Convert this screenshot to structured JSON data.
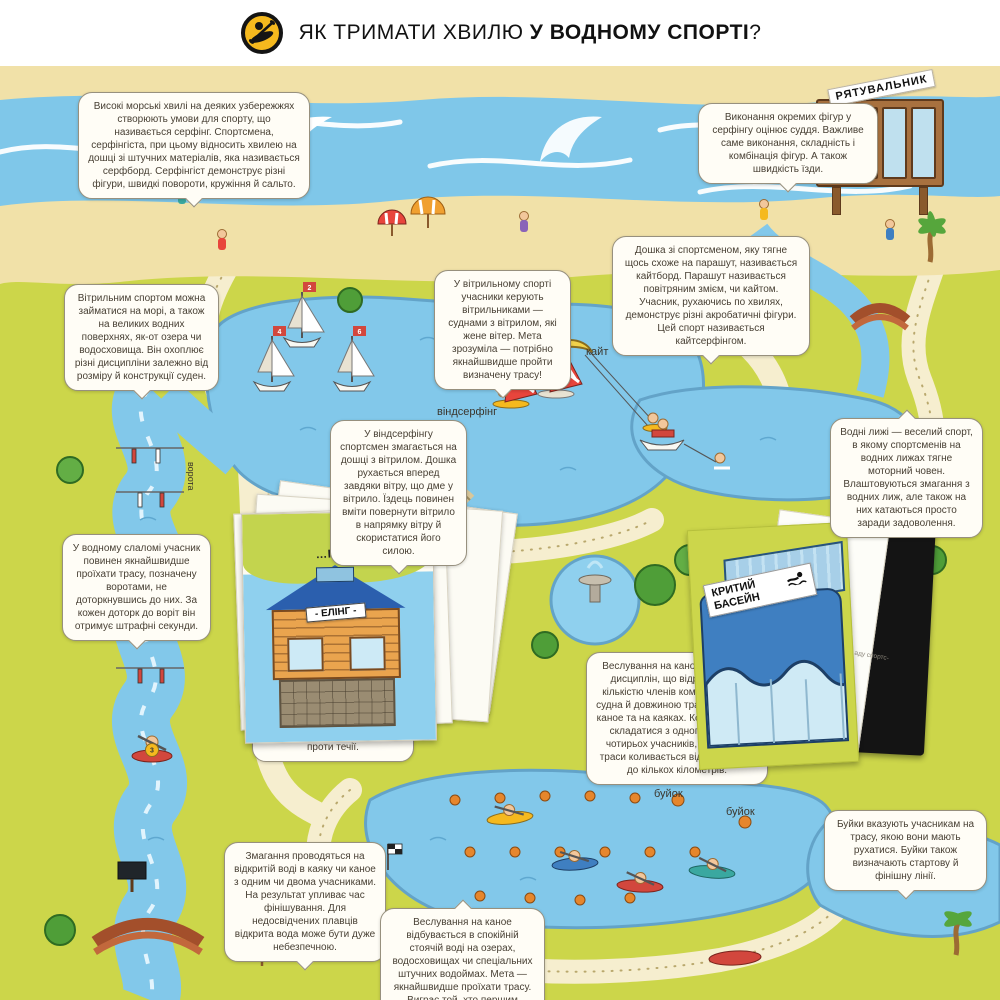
{
  "page": {
    "title": {
      "icon": "kayak-paddler-icon",
      "prefix": "ЯК ТРИМАТИ ХВИЛЮ ",
      "emphasis": "У ВОДНОМУ СПОРТІ",
      "suffix": "?"
    }
  },
  "callouts": {
    "surfing": "Високі морські хвилі на деяких узбережжях створюють умови для спорту, що називається серфінг. Спортсмена, серфінгіста, при цьому відносить хвилею на дошці зі штучних матеріалів, яка називається серфборд. Серфінгіст демонструє різні фігури, швидкі повороти, кружіння й сальто.",
    "surf_judging": "Виконання окремих фігур у серфінгу оцінює суддя. Важливе саме виконання, складність і комбінація фігур. А також швидкість їзди.",
    "kiteboard": "Дошка зі спортсменом, яку тягне щось схоже на парашут, називається кайтборд. Парашут називається повітряним змієм, чи кайтом. Учасник, рухаючись по хвилях, демонструє різні акробатичні фігури. Цей спорт називається кайтсерфінгом.",
    "sailing_overview": "Вітрильним спортом можна займатися на морі, а також на великих водних поверхнях, як-от озера чи водосховища. Він охоплює різні дисципліни залежно від розміру й конструкції суден.",
    "sailing_race": "У вітрильному спорті учасники керують вітрильниками — суднами з вітрилом, які жене вітер. Мета зрозуміла — потрібно якнайшвидше пройти визначену трасу!",
    "windsurfing": "У віндсерфінгу спортсмен змагається на дошці з вітрилом. Дошка рухається вперед завдяки вітру, що дме у вітрило. Їздець повинен вміти повернути вітрило в напрямку вітру й скористатися його силою.",
    "water_ski": "Водні лижі — веселий спорт, в якому спортсменів на водних лижах тягне моторний човен. Влаштовуються змагання з водних лиж, але також на них катаються просто заради задоволення.",
    "water_slalom": "У водному слаломі учасник повинен якнайшвидше проїхати трасу, позначену воротами, не доторкнувшись до них. За кожен доторк до воріт він отримує штрафні секунди.",
    "slalom_gates_partial": "в якому … проїхати спо… білі він має проїхати … води. Червоно-білі ма… подолати проти течії.",
    "canoe_disciplines": "Веслування на каное має кілька дисциплін, що відрізняються кількістю членів команди, типом судна й довжиною траси. Їздять на каное та на каяках. Команда може складатися з одного, двох чи чотирьох учасників, а довжина траси коливається від 200 метрів до кількох кілометрів.",
    "open_water": "Змагання проводяться на відкритій воді в каяку чи каное з одним чи двома учасниками. На результат упливає час фінішування. Для недосвідчених плавців відкрита вода може бути дуже небезпечною.",
    "flat_water": "Веслування на каное відбувається в спокійній стоячій воді на озерах, водосховищах чи спеціальних штучних водоймах. Мета — якнайшвидше проїхати трасу. Виграє той, хто першим досягне фінішу.",
    "buoys": "Буйки вказують учасникам на трасу, якою вони мають рухатися. Буйки також визначають стартову й фінішну лінії."
  },
  "labels": {
    "windsurfing": "віндсерфінг",
    "kite": "кайт",
    "buoy_1": "буйок",
    "buoy_2": "буйок",
    "gates": "ворота"
  },
  "signs": {
    "lifeguard": "РЯТУВАЛЬНИК",
    "boathouse_sign": "- ЕЛІНГ -",
    "kayak_page_title": "…ІЙ ВОДІ — КАЯК",
    "indoor_pool_line1": "КРИТИЙ",
    "indoor_pool_line2": "БАСЕЙН",
    "pool_page_fragments": "…зроблений  …аду спортс-  …оцінює ви-"
  },
  "sails": {
    "numbers": [
      "2",
      "4",
      "6"
    ],
    "slalom_bib": "3"
  },
  "colors": {
    "land": "#ccd64a",
    "sea": "#7fc7e9",
    "lake": "#82c8ea",
    "sand": "#f1e1a8",
    "path": "#f6eecf",
    "accent_yellow": "#f5b91e",
    "buoy_orange": "#e6862c",
    "flag_red": "#d2473d",
    "roof_blue": "#2b5fae",
    "wood": "#a8713f"
  }
}
